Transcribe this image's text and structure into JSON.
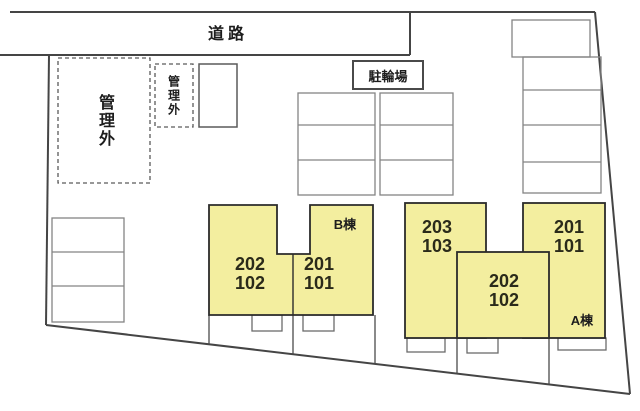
{
  "labels": {
    "road": "道路",
    "outside_management_large": "管理外",
    "outside_management_small": "管理外",
    "bicycle_parking": "駐輪場"
  },
  "building_b": {
    "name": "B棟",
    "units": [
      {
        "upper": "202",
        "lower": "102"
      },
      {
        "upper": "201",
        "lower": "101"
      }
    ]
  },
  "building_a": {
    "name": "A棟",
    "units": [
      {
        "upper": "203",
        "lower": "103"
      },
      {
        "upper": "202",
        "lower": "102"
      },
      {
        "upper": "201",
        "lower": "101"
      }
    ]
  },
  "colors": {
    "building_fill": "#F3EE9F",
    "building_outline": "#2B2B2B",
    "boundary_line": "#454545",
    "parking_line": "#848484"
  }
}
